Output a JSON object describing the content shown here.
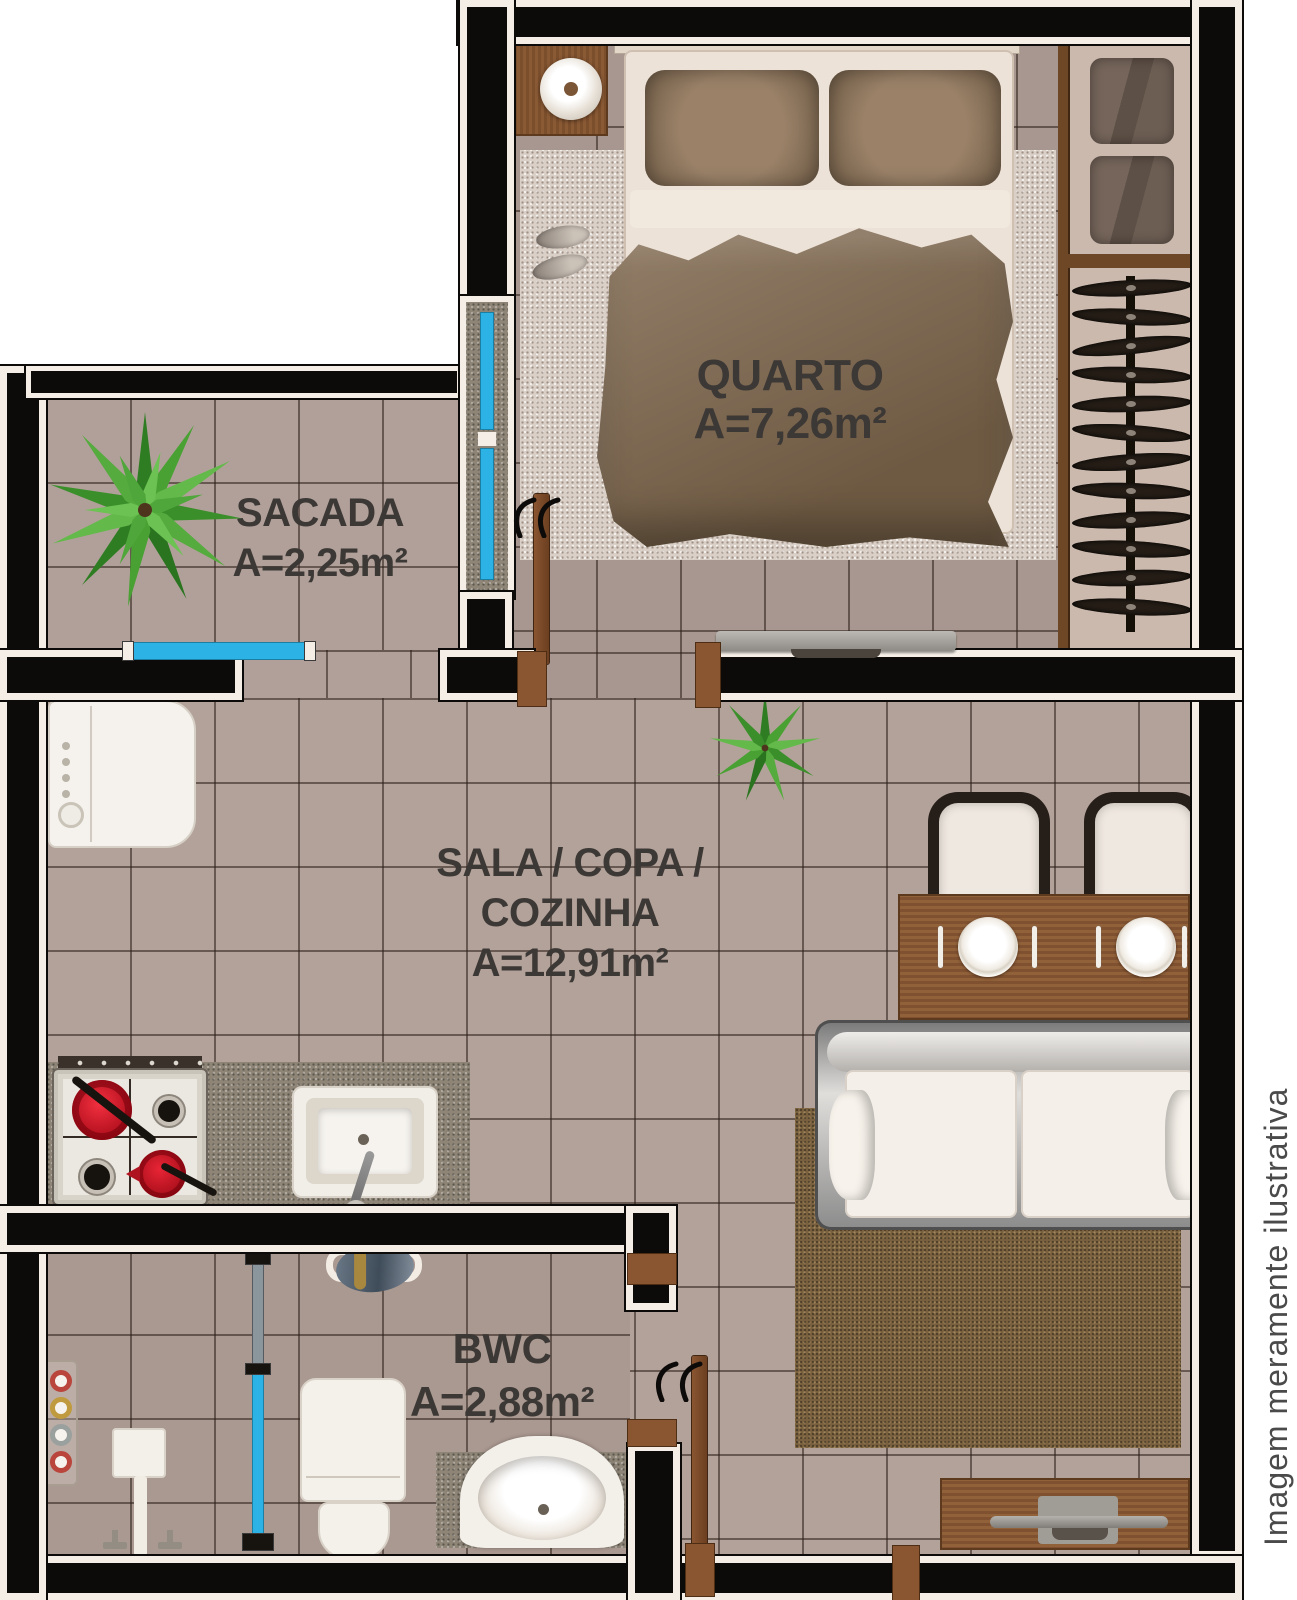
{
  "watermark": "Imagem meramente ilustrativa",
  "rooms": {
    "quarto": {
      "name": "QUARTO",
      "area": "A=7,26m²"
    },
    "sacada": {
      "name": "SACADA",
      "area": "A=2,25m²"
    },
    "sala": {
      "name_line1": "SALA / COPA /",
      "name_line2": "COZINHA",
      "area": "A=12,91m²"
    },
    "bwc": {
      "name": "BWC",
      "area": "A=2,88m²"
    }
  },
  "furniture": {
    "quarto": [
      "double-bed",
      "pillows",
      "duvet",
      "nightstand",
      "table-lamp",
      "slippers",
      "rug",
      "wardrobe-shelves",
      "wardrobe-hanging-rail",
      "wall-tv"
    ],
    "sacada": [
      "potted-plant",
      "glass-railing"
    ],
    "sala_copa_cozinha": [
      "washing-machine",
      "kitchen-counter",
      "stove-with-pots",
      "kitchen-sink",
      "dining-table",
      "chairs",
      "plates",
      "potted-plant",
      "sofa",
      "rug",
      "tv-stand",
      "tv"
    ],
    "bwc": [
      "shower-head",
      "shower-bottles",
      "glass-partition",
      "towel-rail",
      "toilet",
      "vanity-sink",
      "floor-taps"
    ]
  },
  "colors": {
    "wall": "#0d0b09",
    "wall_casing": "#f4eee7",
    "floor_sala": "#b3a29a",
    "floor_quarto": "#a89790",
    "glass_blue": "#2cb2e5",
    "wood_door": "#8a5531",
    "granite": "#8e8577",
    "carpet": "#dad0c7",
    "rug_brown": "#79603f",
    "label_text": "#3c3835",
    "accent_red": "#c3161f"
  }
}
